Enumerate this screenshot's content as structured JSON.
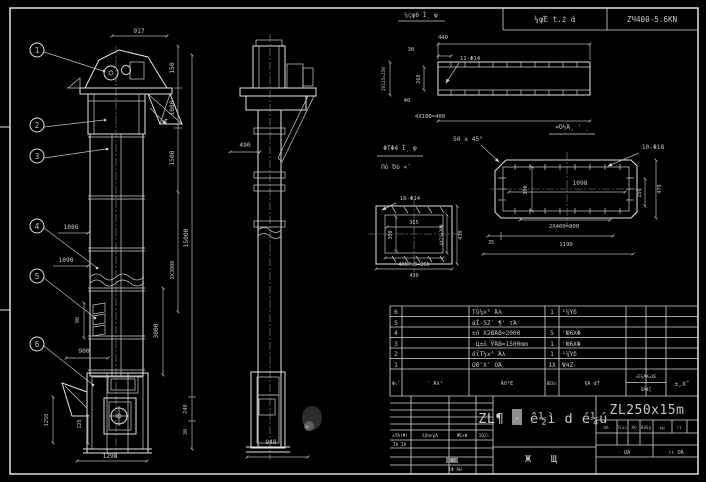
{
  "colors": {
    "background": "#000000",
    "line": "#e4e4e4",
    "dim_line": "#b0b0b0",
    "text": "#c9c9c9",
    "highlight": "#8f8f8f"
  },
  "header": {
    "project_cell": "¼φΈ t.ż ά",
    "model_cell": "ZЧ400-5.6ΚΝ"
  },
  "front_view": {
    "balloons": [
      "1",
      "2",
      "3",
      "4",
      "5",
      "6"
    ],
    "section_mark": "I",
    "dims": {
      "d917": "917",
      "d150": "150",
      "d1080": "1080",
      "d1500": "1500",
      "d15000": "15000",
      "d2x3000": "2X3000",
      "d3000": "3000",
      "d1086": "1086",
      "d1090": "1090",
      "d900": "900",
      "d90": "90",
      "d1250": "1250",
      "d125": "125",
      "d1298": "1298",
      "d240": "240",
      "d30": "30"
    }
  },
  "side_view": {
    "dims": {
      "d490": "490",
      "d948": "948"
    }
  },
  "details": {
    "channel": {
      "title": "¼ςφ6 Ì¸ φ",
      "dims": {
        "len": "440",
        "off": "30",
        "holes": "11-Φ14",
        "left": "2X125=250",
        "web": "260",
        "d40": "40",
        "bottom": "4X100=400"
      }
    },
    "plate": {
      "title": "¤Ό½Ά¸ ' ¸",
      "chamfer": "50 x 45°",
      "holes": "10-Φ18",
      "dims": {
        "inner": "1098",
        "v_in": "390",
        "v150": "150",
        "v470": "470",
        "b800": "2X400=800",
        "d35": "35",
        "b1190": "1190"
      }
    },
    "flange": {
      "title": "ΦΤΦ4 Ì¸ φ",
      "subtitle": "Πό Όύ ×¨",
      "holes": "16-Φ14",
      "dims": {
        "w": "365",
        "h": "300",
        "right_in": "4X75=300",
        "right": "430",
        "b350": "4X87.5=350",
        "b430": "430"
      }
    }
  },
  "bom": {
    "rows": [
      {
        "no": "6",
        "code": "",
        "name": "Τΰ¼х° Άλ",
        "qty": "1",
        "material": "¹¼Ύδ",
        "remark": ""
      },
      {
        "no": "5",
        "code": "",
        "name": "άΪ·5Ζ″ ¶' τΆ",
        "qty": "",
        "material": "",
        "remark": ""
      },
      {
        "no": "4",
        "code": "",
        "name": "±ό Х2ΒΆΒ=2000",
        "qty": "5",
        "material": "'Ю6ΧΦ",
        "remark": ""
      },
      {
        "no": "3",
        "code": "",
        "name": "·Ц±ό ЎΆΒ=1500mm",
        "qty": "1",
        "material": "'Ю6ΧΦ",
        "remark": ""
      },
      {
        "no": "2",
        "code": "",
        "name": "άΐΤ¼х° Άλ",
        "qty": "1",
        "material": "¹¼Ύδ",
        "remark": ""
      },
      {
        "no": "1",
        "code": "",
        "name": "ΟΘ″Х″ ΟΆ",
        "qty": "1Х",
        "material": "Ψ4Ζ·",
        "remark": ""
      }
    ],
    "footer": {
      "no": "Φι΅",
      "code": "' Άλ¹",
      "name": "ΆΟ¹Ε",
      "qty": "ΒΈΟι",
      "material": "§Ά άΤ",
      "weight": "«Έ¼ΆХ±ΧΕ",
      "weight_sub": "ΟΆ4ζ",
      "remark": "±,Х΅"
    }
  },
  "title_block": {
    "title": "ZL¶ · ê½ì d é¼ú",
    "subtitle_left": "Ж",
    "subtitle_right": "Щ",
    "model": "ZL250x15m",
    "rev_header": [
      "±ΫΆ(Ψ)",
      "ξΟπερΆ",
      "ΨΈ×Φ",
      "ΊΟΖι"
    ],
    "sig_label": "ΪΗ ΊΆ",
    "stamp": "ΞΦΕ",
    "approve_label": "ΊΦ ΆΗ",
    "info_header": [
      "πό",
      "Πι±ι",
      "Χύ",
      "Ούξγ",
      "±μ",
      "ιτ"
    ],
    "sheet_left": "· ΟΆ",
    "sheet_right": "ιι ΟΆ"
  }
}
